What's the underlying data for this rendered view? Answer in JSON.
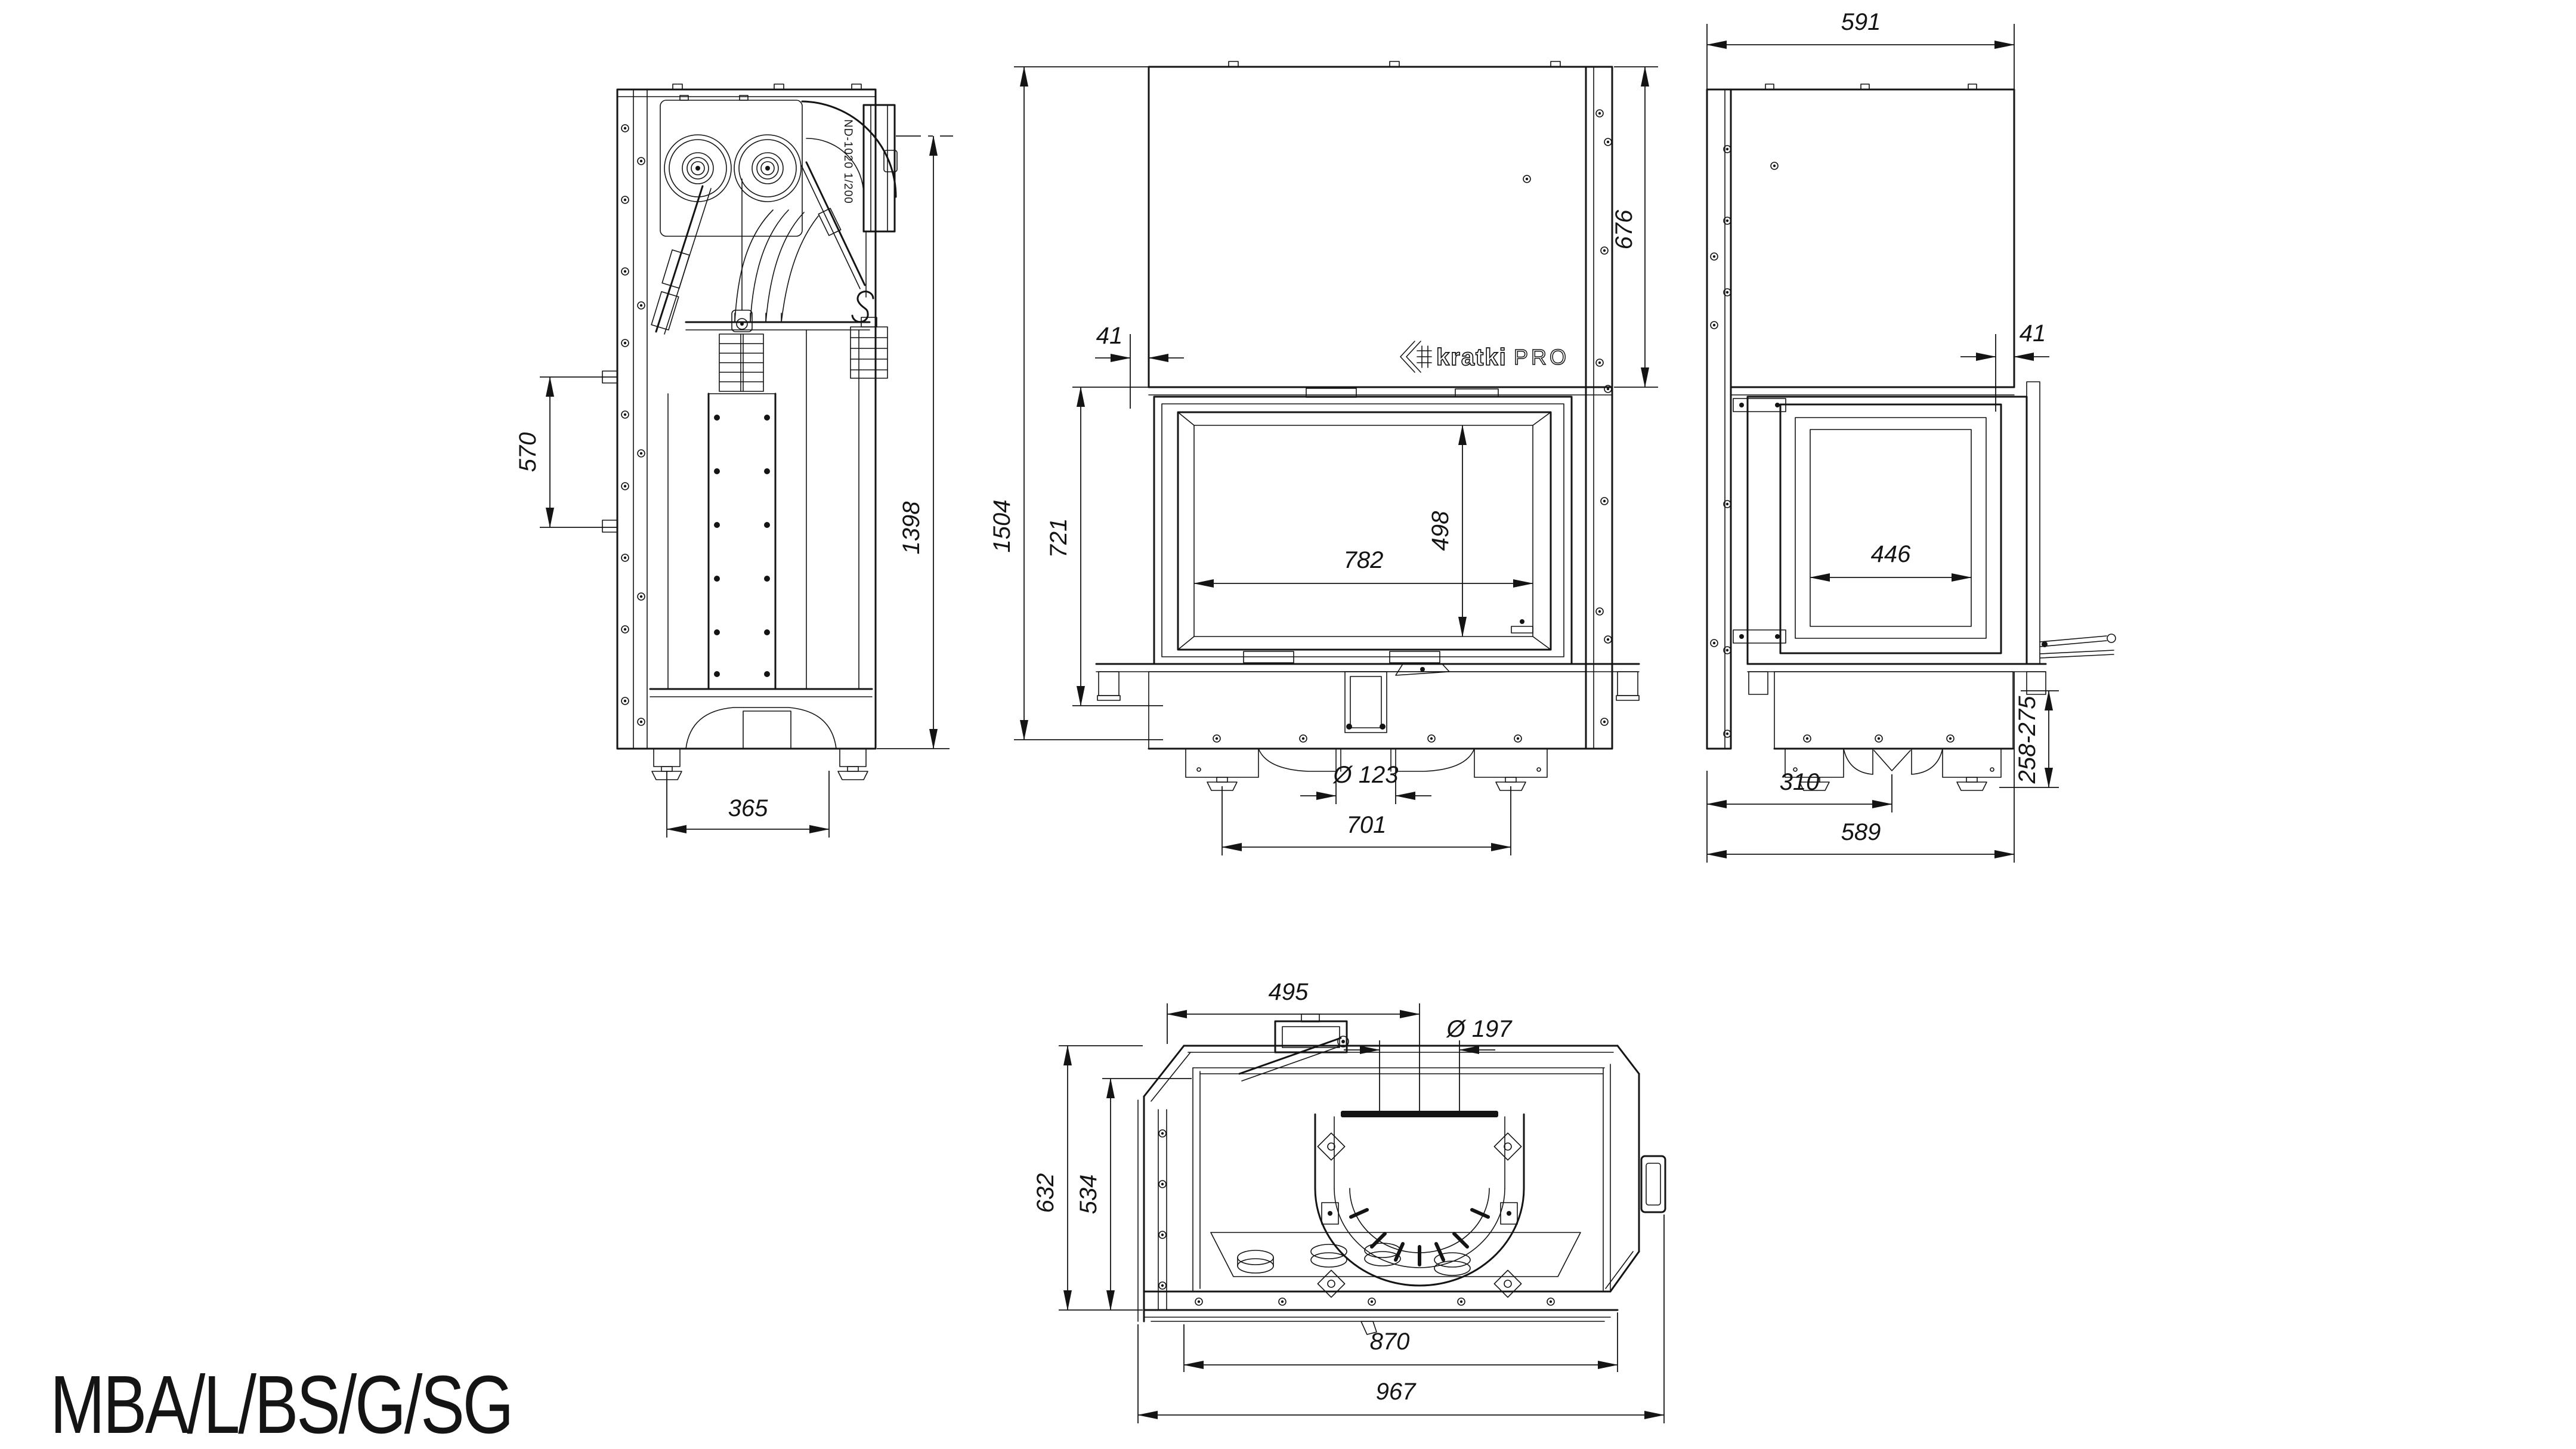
{
  "labels": {
    "model": "MBA/L/BS/G/SG",
    "duct": "ND-1020 1/200"
  },
  "brand": {
    "name": "kratki",
    "suffix": "PRO"
  },
  "colors": {
    "ink": "#141414",
    "background": "#ffffff"
  },
  "views": {
    "side": "left side section view",
    "front": "front view",
    "right": "right side view",
    "top": "top view"
  },
  "dims": {
    "side_570": "570",
    "side_1398": "1398",
    "side_365": "365",
    "front_1504": "1504",
    "front_721": "721",
    "front_41": "41",
    "front_676": "676",
    "front_782": "782",
    "front_498": "498",
    "front_43": "43",
    "front_flue": "Ø 123",
    "front_701": "701",
    "right_591": "591",
    "right_41": "41",
    "right_446": "446",
    "right_feet": "258-275",
    "right_310": "310",
    "right_589": "589",
    "top_495": "495",
    "top_flue": "Ø 197",
    "top_632": "632",
    "top_534": "534",
    "top_870": "870",
    "top_967": "967"
  }
}
